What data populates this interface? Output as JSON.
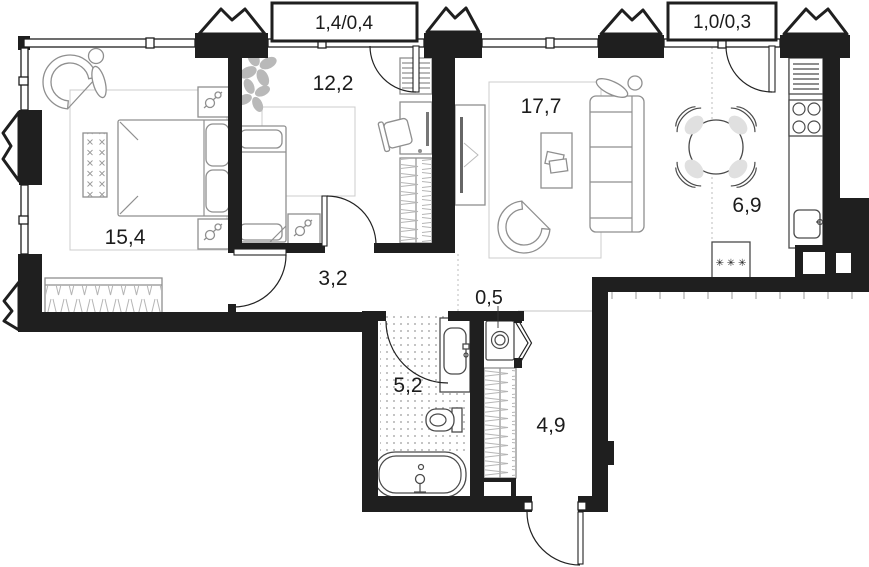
{
  "plan_title": "apartment-floor-plan",
  "rooms": {
    "bedroom": {
      "area_label": "15,4"
    },
    "kids_room": {
      "area_label": "12,2"
    },
    "living_room": {
      "area_label": "17,7"
    },
    "kitchen": {
      "area_label": "6,9"
    },
    "corridor": {
      "area_label": "3,2"
    },
    "bathroom": {
      "area_label": "5,2"
    },
    "laundry_niche": {
      "area_label": "0,5"
    },
    "hallway": {
      "area_label": "4,9"
    },
    "balcony_left": {
      "area_label": "1,4/0,4"
    },
    "balcony_right": {
      "area_label": "1,0/0,3"
    }
  },
  "symbols": {
    "fridge_snowflakes": "✳ ✳ ✳"
  },
  "colors": {
    "wall": "#1f1f1f",
    "furniture_outline": "#8f8f8f",
    "fixture_outline": "#4a4a4a",
    "zone_outline": "#cccccc",
    "hatch": "#b5b5b5",
    "plant": "#b9b9b9",
    "label": "#1c1c1c",
    "background": "#ffffff"
  }
}
